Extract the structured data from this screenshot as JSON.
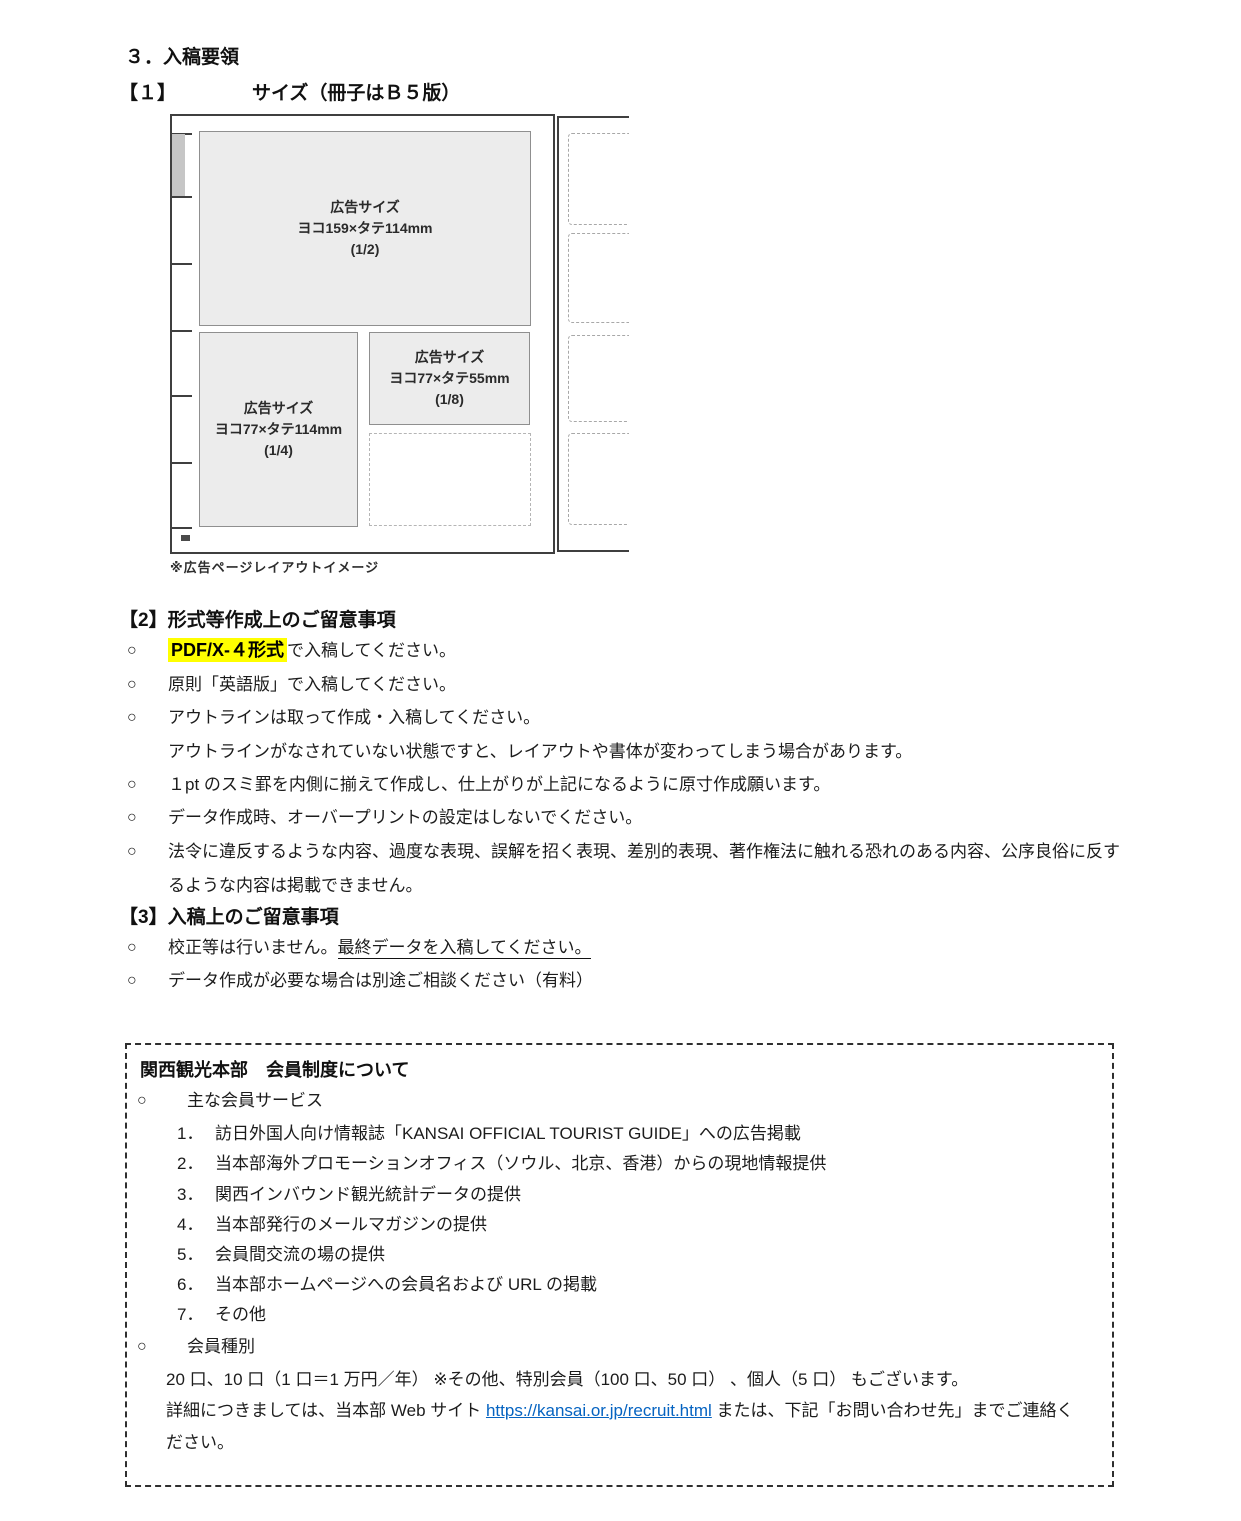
{
  "titles": {
    "main": "３．入稿要領",
    "sub_num": "【１】",
    "sub_text": "サイズ（冊子はＢ５版）"
  },
  "bullet": "○",
  "diagram": {
    "caption": "※広告ページレイアウトイメージ",
    "half": {
      "title": "広告サイズ",
      "size": "ヨコ159×タテ114mm",
      "frac": "(1/2)"
    },
    "quarter": {
      "title": "広告サイズ",
      "size": "ヨコ77×タテ114mm",
      "frac": "(1/4)"
    },
    "eighth": {
      "title": "広告サイズ",
      "size": "ヨコ77×タテ55mm",
      "frac": "(1/8)"
    }
  },
  "section2": {
    "heading": "【2】形式等作成上のご留意事項",
    "item1_hl": "PDF/X-４形式",
    "item1_rest": "で入稿してください。",
    "item2": "原則「英語版」で入稿してください。",
    "item3": "アウトラインは取って作成・入稿してください。",
    "item3_note": "アウトラインがなされていない状態ですと、レイアウトや書体が変わってしまう場合があります。",
    "item4": "１pt のスミ罫を内側に揃えて作成し、仕上がりが上記になるように原寸作成願います。",
    "item5": "データ作成時、オーバープリントの設定はしないでください。",
    "item6_line1": "法令に違反するような内容、過度な表現、誤解を招く表現、差別的表現、著作権法に触れる恐れのある内容、公序良俗に反す",
    "item6_line2": "るような内容は掲載できません。"
  },
  "section3": {
    "heading": "【3】入稿上のご留意事項",
    "item1_plain": "校正等は行いません。",
    "item1_underlined": "最終データを入稿してください。",
    "item2": "データ作成が必要な場合は別途ご相談ください（有料）"
  },
  "membership": {
    "title": "関西観光本部　会員制度について",
    "services_heading": "主な会員サービス",
    "services": [
      {
        "num": "1．",
        "text": "訪日外国人向け情報誌「KANSAI OFFICIAL TOURIST GUIDE」への広告掲載"
      },
      {
        "num": "2．",
        "text": "当本部海外プロモーションオフィス（ソウル、北京、香港）からの現地情報提供"
      },
      {
        "num": "3．",
        "text": "関西インバウンド観光統計データの提供"
      },
      {
        "num": "4．",
        "text": "当本部発行のメールマガジンの提供"
      },
      {
        "num": "5．",
        "text": "会員間交流の場の提供"
      },
      {
        "num": "6．",
        "text": "当本部ホームページへの会員名および URL の掲載"
      },
      {
        "num": "7．",
        "text": "その他"
      }
    ],
    "types_heading": "会員種別",
    "types_line": "20 口、10 口（1 口＝1 万円／年） ※その他、特別会員（100 口、50 口） 、個人（5 口） もございます。",
    "detail_pre": "詳細につきましては、当本部 Web サイト ",
    "detail_link": "https://kansai.or.jp/recruit.html",
    "detail_post": " または、下記「お問い合わせ先」までご連絡く",
    "detail_line2": "ださい。"
  },
  "colors": {
    "highlight": "#ffff00",
    "link": "#0563c1"
  }
}
